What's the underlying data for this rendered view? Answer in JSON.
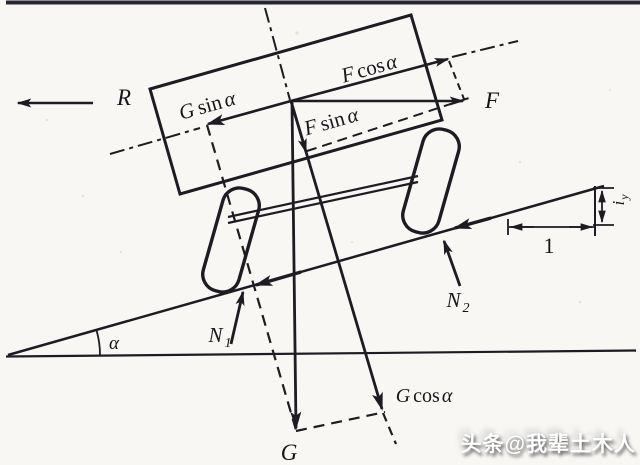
{
  "figure": {
    "description": "Free-body diagram of a vehicle on an inclined slope",
    "labels": {
      "r": "R",
      "gsin": {
        "sym": "G",
        "fn": "sin",
        "arg": "α"
      },
      "fcos": {
        "sym": "F",
        "fn": "cos",
        "arg": "α"
      },
      "fsin": {
        "sym": "F",
        "fn": "sin",
        "arg": "α"
      },
      "f": "F",
      "n1": {
        "sym": "N",
        "sub": "1"
      },
      "n2": {
        "sym": "N",
        "sub": "2"
      },
      "alpha": "α",
      "g": "G",
      "gcos": {
        "sym": "G",
        "fn": "cos",
        "arg": "α"
      },
      "one": "1",
      "iy": {
        "sym": "i",
        "sub": "y"
      }
    },
    "colors": {
      "ink": "#1c1c22",
      "background": "#f8f7f4",
      "top_border": "#26262f",
      "watermark_text": "#ffffff"
    }
  },
  "watermark": "头条@我辈土木人"
}
